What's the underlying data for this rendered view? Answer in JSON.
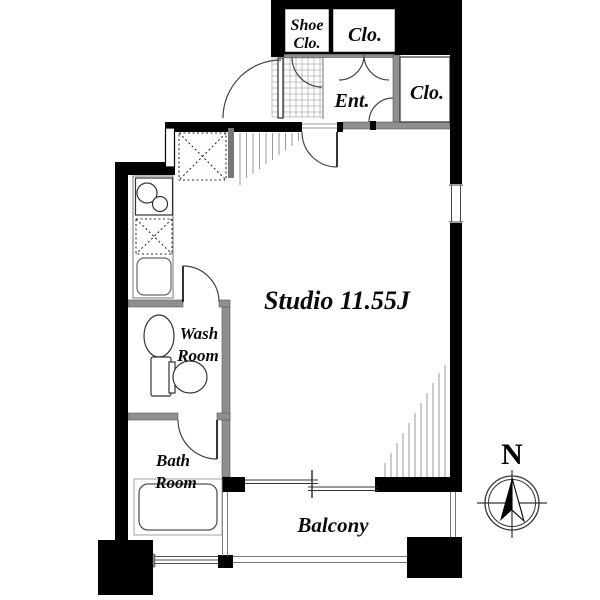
{
  "title": "Studio apartment floor plan",
  "rooms": {
    "studio": {
      "label": "Studio 11.55J"
    },
    "entrance": {
      "label": "Ent."
    },
    "shoe_closet": {
      "line1": "Shoe",
      "line2": "Clo."
    },
    "closet_top": {
      "label": "Clo."
    },
    "closet_right": {
      "label": "Clo."
    },
    "wash_room": {
      "line1": "Wash",
      "line2": "Room"
    },
    "bath_room": {
      "line1": "Bath",
      "line2": "Room"
    },
    "balcony": {
      "label": "Balcony"
    }
  },
  "compass": {
    "north_label": "N"
  },
  "fixtures": [
    "refrigerator-space",
    "two-burner-stove",
    "counter-space",
    "kitchen-sink",
    "wash-basin",
    "toilet",
    "bathtub",
    "sliding-window",
    "entrance-tile-floor"
  ],
  "colors": {
    "wall": "#000000",
    "partition": "#8f8f8f",
    "hatch": "#999999",
    "grid": "#b0b0b0",
    "line": "#333333",
    "background": "#ffffff"
  }
}
